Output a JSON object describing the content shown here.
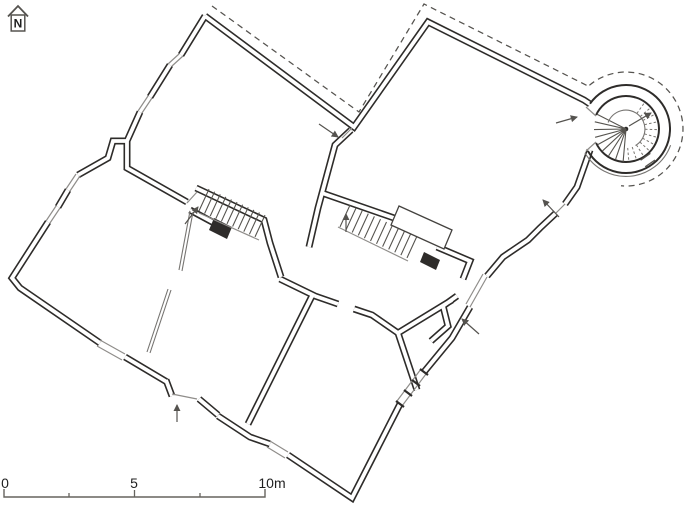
{
  "canvas": {
    "width": 689,
    "height": 512,
    "background": "#ffffff"
  },
  "north_indicator": {
    "icon": "north-arrow-house-icon",
    "label": "N"
  },
  "scale_bar": {
    "start_label": "0",
    "middle_label": "5",
    "end_label": "10m",
    "units": "meters",
    "major_ticks": [
      0,
      5,
      10
    ],
    "minor_ticks": [
      2.5,
      7.5
    ]
  },
  "drawing": {
    "type": "architectural-floor-plan",
    "description": "Rotated ground-floor plan of an irregular historic building with a round corner tower containing a spiral staircase, two straight interior staircases, window and door openings with direction arrows, and a dashed line marking the overhanging upper storey / roof outline.",
    "colors": {
      "walls": "#2e2c2a",
      "thin_lines": "#8f8d8a",
      "dashed_lines": "#55534f",
      "text": "#1f1f1f"
    }
  }
}
